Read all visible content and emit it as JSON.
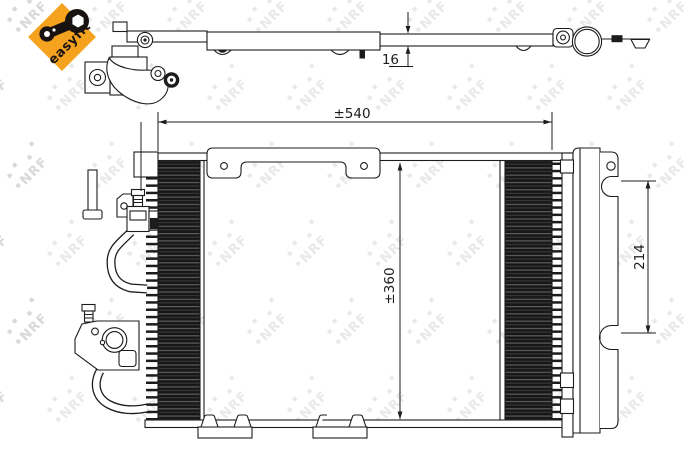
{
  "badge": {
    "label": "easyfit",
    "icon": "wrench-icon",
    "background": "#F5A21E",
    "text_color": "#1b1410"
  },
  "watermark": {
    "text": "NRF",
    "color": "#e9e9e9",
    "edge_color": "#d9d9d9"
  },
  "drawing": {
    "line_color": "#1c1c1c",
    "dimensions": {
      "depth": "16",
      "width": "±540",
      "height": "±360",
      "bracket_spacing": "214"
    }
  }
}
